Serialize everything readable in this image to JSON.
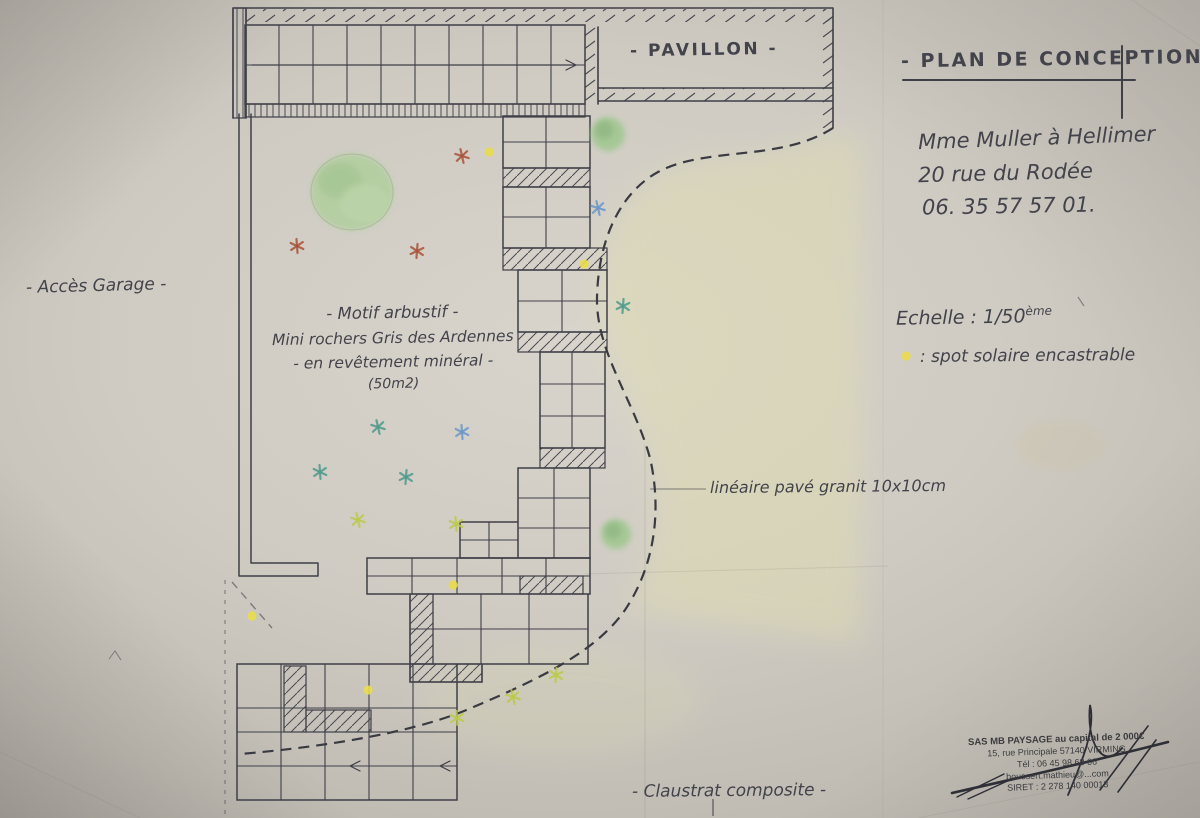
{
  "titleblock": {
    "title": "- PLAN DE CONCEPTION -",
    "client1": "Mme Muller à Hellimer",
    "client2": "20 rue du Rodée",
    "client3": "06. 35 57 57 01."
  },
  "scale": {
    "label": "Echelle : 1/50",
    "sup": "ème"
  },
  "legend": {
    "symbol": "yellow-spot-dot",
    "text": ": spot solaire encastrable"
  },
  "labels": {
    "pavillon": "- PAVILLON -",
    "acces": "- Accès Garage -",
    "lineaire": "linéaire pavé granit 10x10cm",
    "claustra": "- Claustrat composite -"
  },
  "motif": {
    "line1": "- Motif arbustif -",
    "line2": "Mini rochers Gris des Ardennes",
    "line3": "- en revêtement minéral -",
    "line4": "(50m2)"
  },
  "stamp": {
    "line1": "SAS MB PAYSAGE au capital de 2 000€",
    "line2": "15, rue Principale 57140 VIRMING",
    "line3": "Tél : 06 45 98 68 06",
    "line4": "boussert.mathieu@...com",
    "line5": "SIRET : 2 278 140 00013"
  },
  "colors": {
    "ink": "#3f3f47",
    "pencil_green": "#a3c98f",
    "spot_yellow": "#e9dc4d",
    "star_red": "#a8543a",
    "star_blue": "#6b97c9",
    "star_teal": "#4f9a8c",
    "star_lime": "#bcca4a",
    "lawn_tint": "#e3e0ae"
  }
}
